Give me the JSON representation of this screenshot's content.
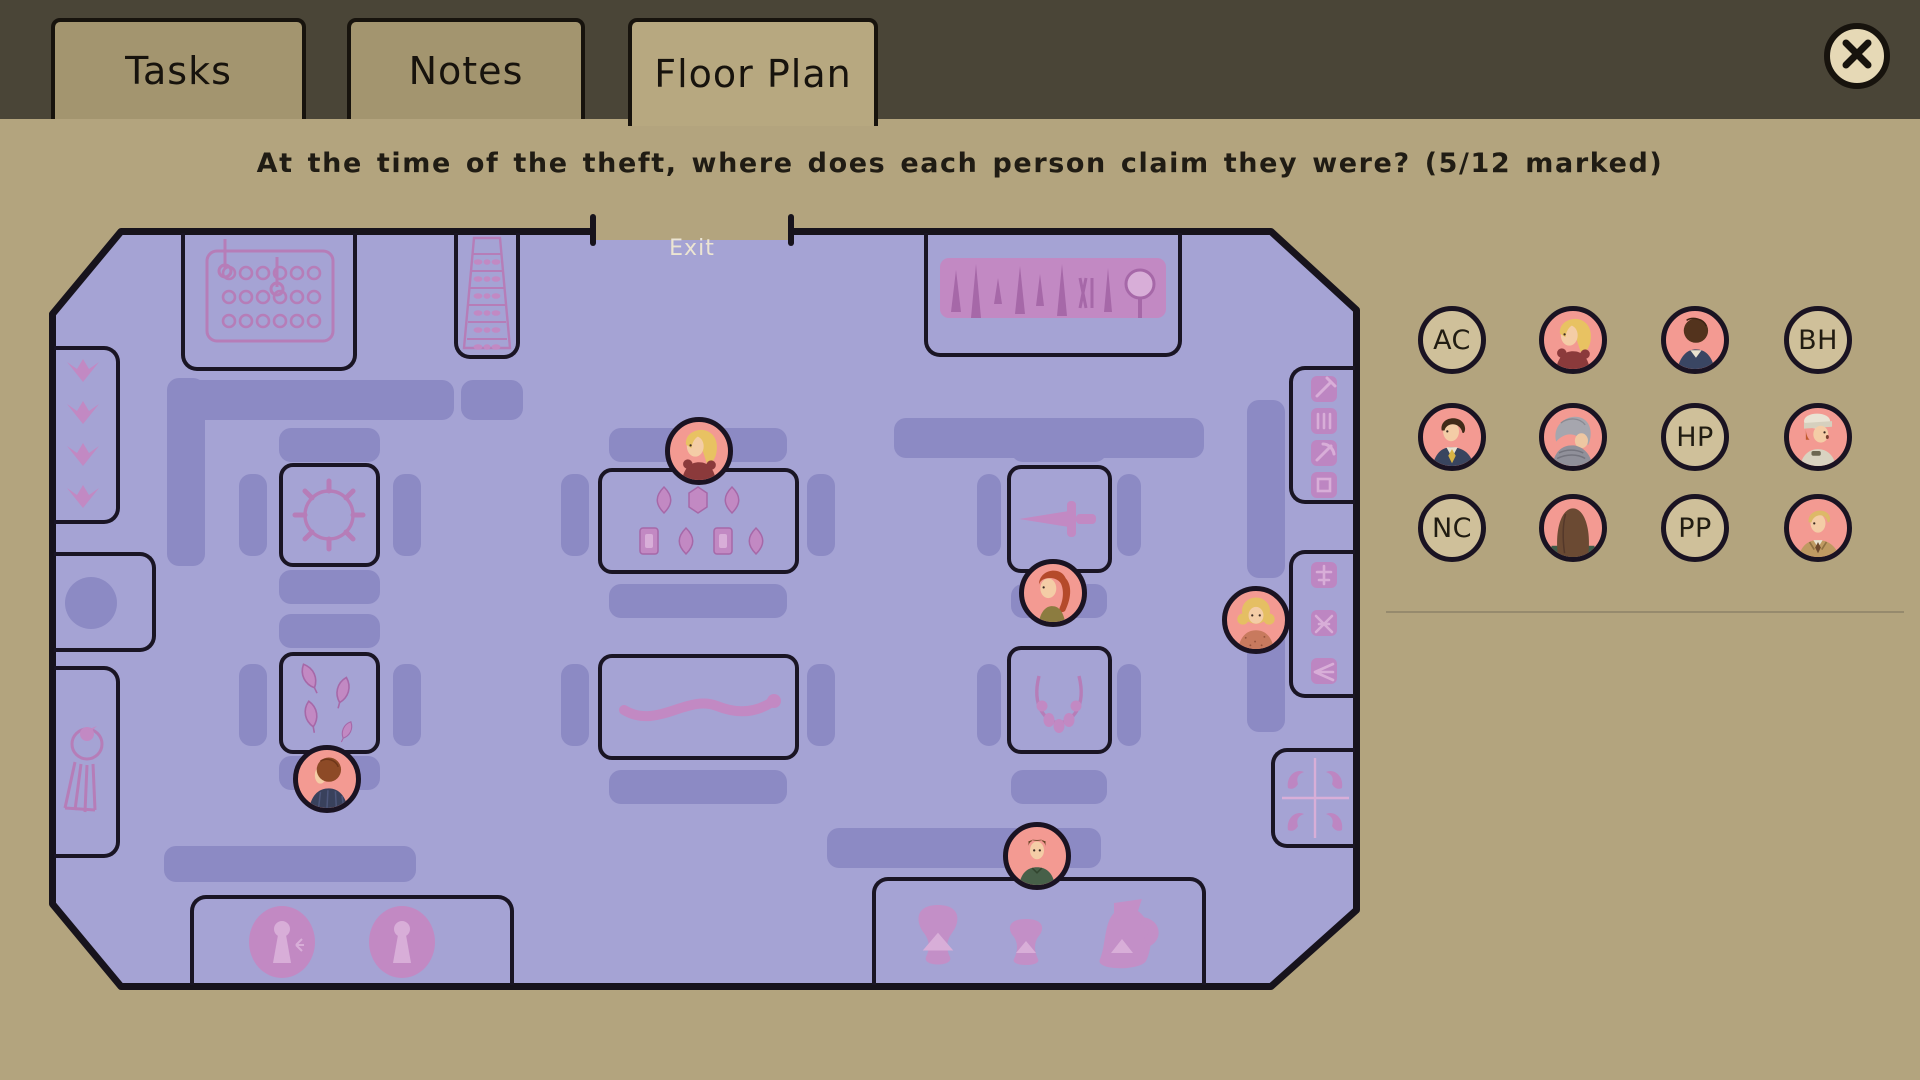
{
  "header": {
    "tabs": [
      {
        "id": "tasks",
        "label": "Tasks",
        "active": false
      },
      {
        "id": "notes",
        "label": "Notes",
        "active": false
      },
      {
        "id": "floor-plan",
        "label": "Floor Plan",
        "active": true
      }
    ],
    "close_icon": "close-x"
  },
  "question": "At the time of the theft, where does each person claim they were? (5/12 marked)",
  "progress_marked": "5/12",
  "floor_plan": {
    "exit_label": "Exit",
    "displays": [
      {
        "id": "coin-panel-display",
        "name": "coin panel display case"
      },
      {
        "id": "shelf-display",
        "name": "shelf rack display"
      },
      {
        "id": "tools-display",
        "name": "blades and tools display case"
      },
      {
        "id": "sun-display",
        "name": "spiked ring display case"
      },
      {
        "id": "jewel-display",
        "name": "gemstones display case"
      },
      {
        "id": "dagger-display",
        "name": "dagger display case"
      },
      {
        "id": "arrowhead-display",
        "name": "arrowheads display case"
      },
      {
        "id": "snake-display",
        "name": "serpent artifact display case"
      },
      {
        "id": "necklace-display",
        "name": "necklace display case"
      },
      {
        "id": "medallion-display",
        "name": "medallions display case"
      },
      {
        "id": "pottery-display",
        "name": "pottery display case"
      },
      {
        "id": "flower-nook",
        "name": "wall niche with floral carvings"
      },
      {
        "id": "statue-nook",
        "name": "wall niche with round plinth"
      },
      {
        "id": "bird-nook",
        "name": "wall niche with bird relief"
      },
      {
        "id": "tool-rack-nook",
        "name": "wall rack of small tools"
      },
      {
        "id": "pin-rack-nook",
        "name": "wall rack of pins and needles"
      },
      {
        "id": "birdcarving-nook",
        "name": "wall niche with four bird carvings"
      }
    ],
    "placed_tokens": [
      {
        "id": "blonde-woman",
        "desc": "blonde woman in dark red dress",
        "x": 650,
        "y": 223
      },
      {
        "id": "redhead-ponytail",
        "desc": "red-haired woman with ponytail",
        "x": 1004,
        "y": 365
      },
      {
        "id": "blonde-curly",
        "desc": "curly blonde woman in salmon blouse",
        "x": 1207,
        "y": 392
      },
      {
        "id": "auburn-man-suit",
        "desc": "auburn-haired man in pinstripe suit",
        "x": 278,
        "y": 551
      },
      {
        "id": "green-shirt",
        "desc": "person in green shirt",
        "x": 988,
        "y": 628
      }
    ]
  },
  "roster": {
    "tokens": [
      {
        "type": "initials",
        "label": "AC"
      },
      {
        "type": "portrait",
        "portrait": "blonde-woman"
      },
      {
        "type": "portrait",
        "portrait": "darkhair-back"
      },
      {
        "type": "initials",
        "label": "BH"
      },
      {
        "type": "portrait",
        "portrait": "darkhair-suit"
      },
      {
        "type": "portrait",
        "portrait": "gray-elder"
      },
      {
        "type": "initials",
        "label": "HP"
      },
      {
        "type": "portrait",
        "portrait": "redhead-cap"
      },
      {
        "type": "initials",
        "label": "NC"
      },
      {
        "type": "portrait",
        "portrait": "brunette-back"
      },
      {
        "type": "initials",
        "label": "PP"
      },
      {
        "type": "portrait",
        "portrait": "blond-tan-suit"
      }
    ]
  },
  "colors": {
    "header_bg": "#4a4537",
    "page_bg": "#b3a47e",
    "floor": "#a5a3d4",
    "bench": "#8c8ac4",
    "artifact_pink": "#b67db8",
    "token_pink": "#f39a92",
    "token_tan": "#cfc09a",
    "outline": "#17130d"
  }
}
